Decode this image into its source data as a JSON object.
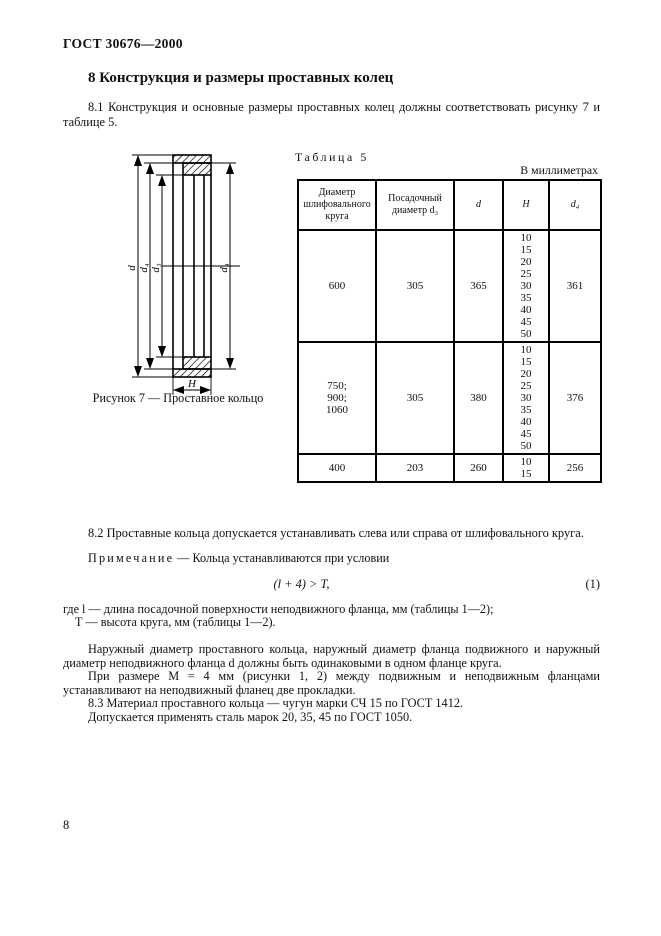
{
  "page": {
    "header": "ГОСТ 30676—2000",
    "number": "8"
  },
  "section": {
    "heading": "8 Конструкция и размеры проставных колец",
    "para_8_1": "8.1 Конструкция и основные размеры проставных колец должны соответствовать рисунку 7 и таблице 5."
  },
  "figure": {
    "caption": "Рисунок 7 — Проставное кольцо",
    "labels": {
      "d": "d",
      "d4_left": "d₄",
      "d3": "d₃",
      "d4_right": "d₄",
      "H": "H"
    }
  },
  "table": {
    "title": "Таблица 5",
    "units_note": "В миллиметрах",
    "columns": {
      "wheel_diameter": "Диаметр шлифовального круга",
      "seat_diameter": "Посадочный диаметр d₃",
      "d": "d",
      "H": "H",
      "d4": "d₄"
    },
    "rows": [
      {
        "wheel_diameter": "600",
        "seat_diameter": "305",
        "d": "365",
        "H": "10\n15\n20\n25\n30\n35\n40\n45\n50",
        "d4": "361"
      },
      {
        "wheel_diameter": "750;\n900;\n1060",
        "seat_diameter": "305",
        "d": "380",
        "H": "10\n15\n20\n25\n30\n35\n40\n45\n50",
        "d4": "376"
      },
      {
        "wheel_diameter": "400",
        "seat_diameter": "203",
        "d": "260",
        "H": "10\n15",
        "d4": "256"
      }
    ]
  },
  "body": {
    "para_8_2": "8.2 Проставные кольца допускается устанавливать слева или справа от шлифовального круга.",
    "note_label": "Примечание",
    "note_text": " — Кольца устанавливаются при условии",
    "formula": "(l + 4) > T,",
    "formula_number": "(1)",
    "where_l": "где l — длина посадочной поверхности неподвижного фланца, мм (таблицы 1—2);",
    "where_T": "Т — высота круга, мм (таблицы 1—2).",
    "para_outer_diameters": "Наружный диаметр проставного кольца, наружный диаметр фланца подвижного и наружный диаметр неподвижного фланца d должны быть одинаковыми в одном фланце круга.",
    "para_m4": "При размере М = 4 мм (рисунки 1, 2) между подвижным и неподвижным фланцами устанавливают на неподвижный фланец две прокладки.",
    "para_8_3": "8.3 Материал проставного кольца — чугун марки СЧ 15 по ГОСТ 1412.",
    "para_steel": "Допускается применять сталь марок 20, 35, 45 по ГОСТ 1050."
  }
}
